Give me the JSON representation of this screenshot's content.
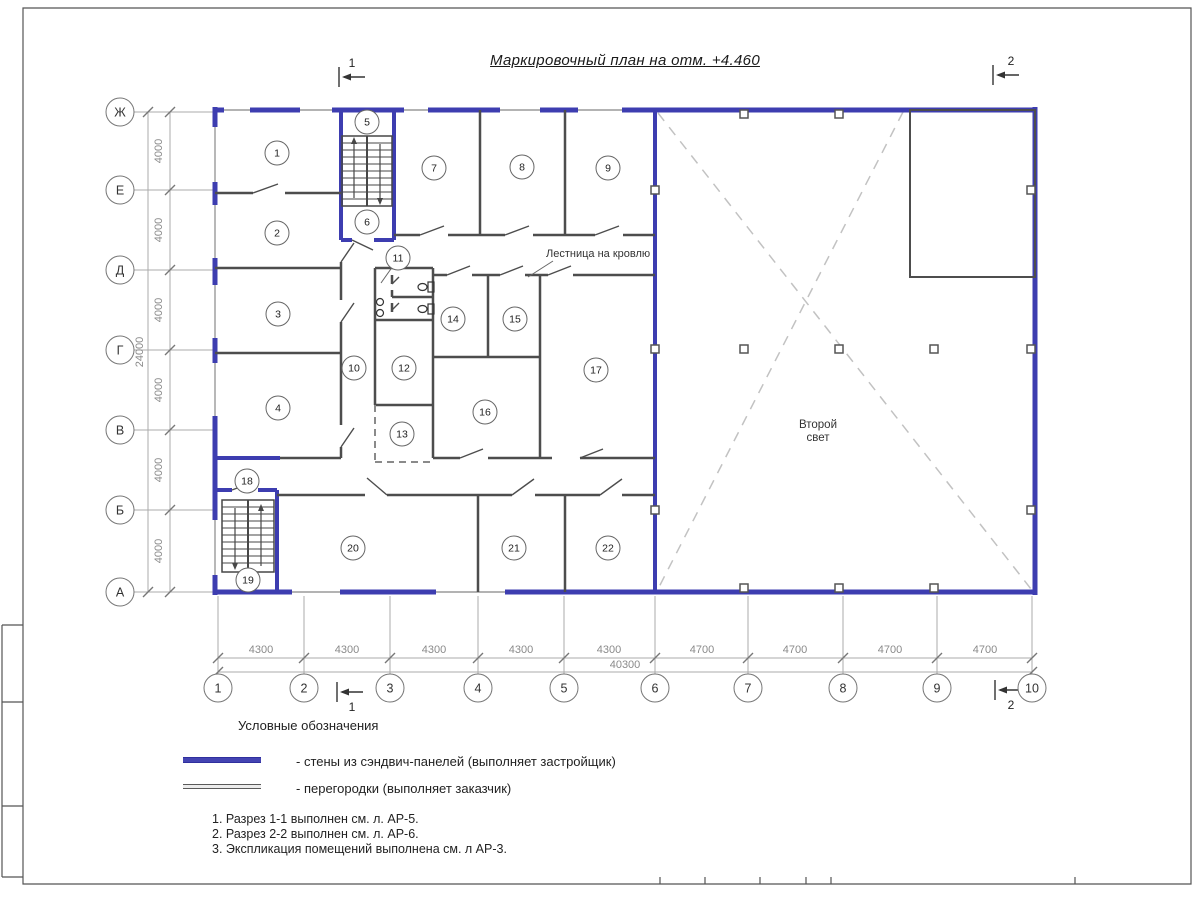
{
  "sheet": {
    "title": "Маркировочный план на отм. +4.460"
  },
  "plan": {
    "rooms": [
      "1",
      "2",
      "3",
      "4",
      "5",
      "6",
      "7",
      "8",
      "9",
      "10",
      "11",
      "12",
      "13",
      "14",
      "15",
      "16",
      "17",
      "18",
      "19",
      "20",
      "21",
      "22"
    ],
    "stairs_to_roof": "Лестница на кровлю",
    "second_light": "Второй свет",
    "wall_color": "#3d3db0",
    "partition_color": "#4d4d4d"
  },
  "axes": {
    "rows": [
      "Ж",
      "Е",
      "Д",
      "Г",
      "В",
      "Б",
      "А"
    ],
    "cols": [
      "1",
      "2",
      "3",
      "4",
      "5",
      "6",
      "7",
      "8",
      "9",
      "10"
    ],
    "row_spacings": [
      "4000",
      "4000",
      "4000",
      "4000",
      "4000",
      "4000"
    ],
    "row_total": "24000",
    "col_spacings": [
      "4300",
      "4300",
      "4300",
      "4300",
      "4300",
      "4700",
      "4700",
      "4700",
      "4700"
    ],
    "col_total": "40300"
  },
  "sections": {
    "top_left": "1",
    "top_right": "2",
    "bottom_left": "1",
    "bottom_right": "2"
  },
  "legend": {
    "heading": "Условные обозначения",
    "items": [
      {
        "name": "sandwich-wall",
        "color": "#4444b2",
        "label": "- стены из сэндвич-панелей (выполняет застройщик)"
      },
      {
        "name": "partition",
        "color": "#5a5a5a",
        "label": "- перегородки (выполняет заказчик)"
      }
    ],
    "notes": [
      "1. Разрез 1-1 выполнен см. л. АР-5.",
      "2. Разрез 2-2 выполнен см. л. АР-6.",
      "3. Экспликация помещений выполнена см. л АР-3."
    ]
  }
}
